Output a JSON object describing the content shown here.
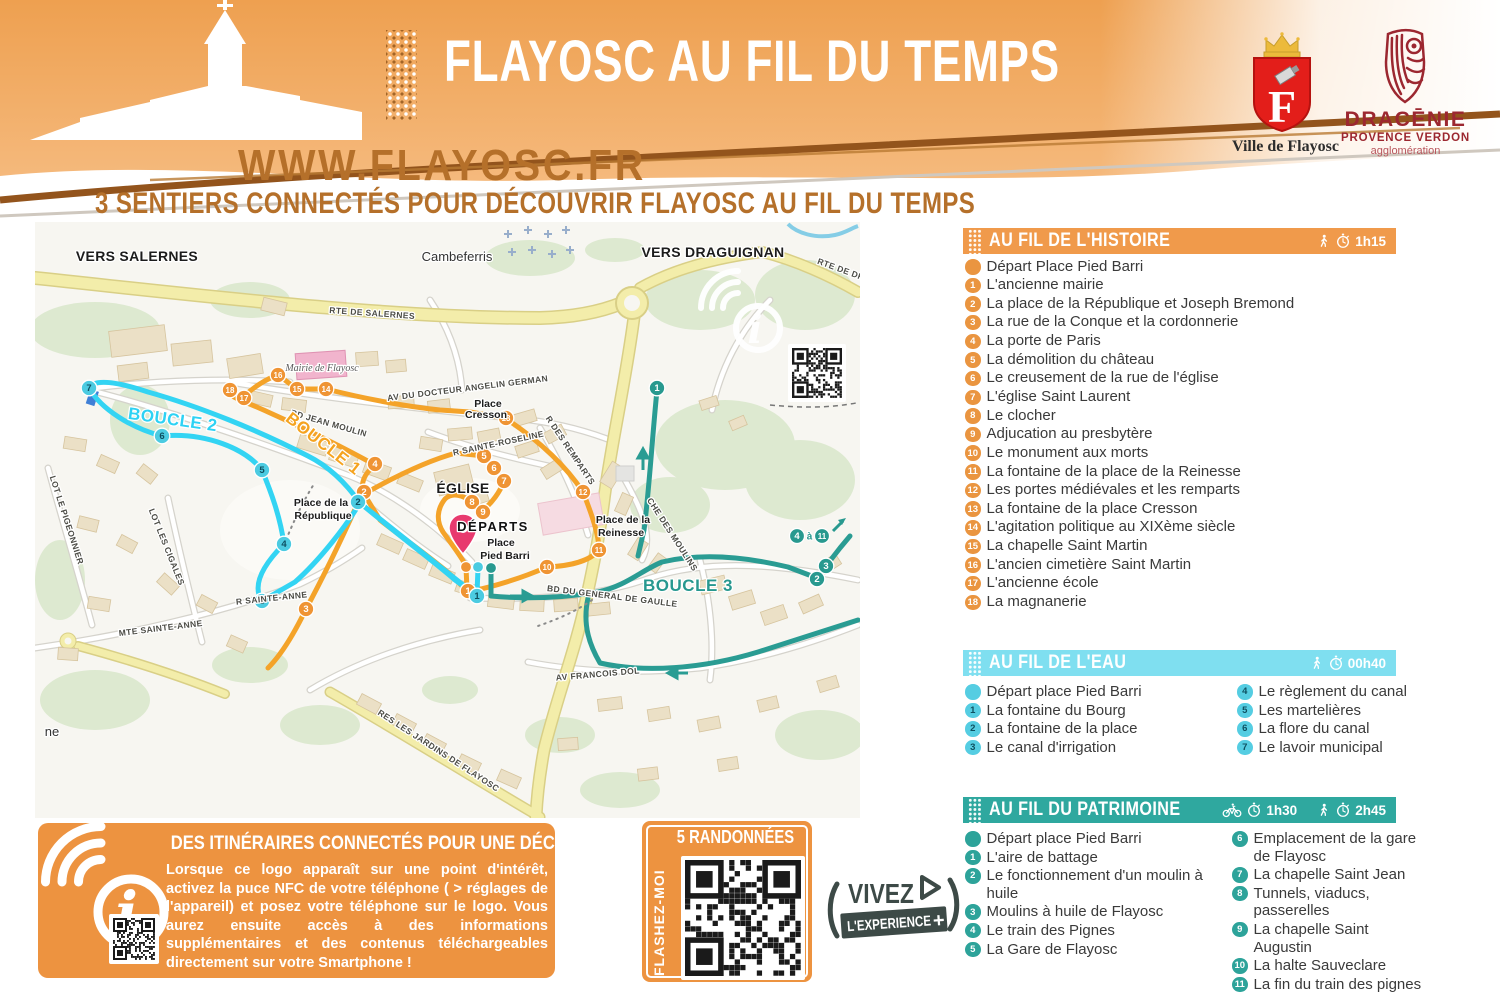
{
  "header": {
    "title": "FLAYOSC AU FIL DU TEMPS",
    "website": "WWW.FLAYOSC.FR",
    "subtitle": "3 SENTIERS CONNECTÉS POUR DÉCOUVRIR FLAYOSC AU FIL DU TEMPS",
    "ville_logo_letter": "F",
    "ville_logo_caption": "Ville de Flayosc",
    "dracenie_line1": "DRACĒNIE",
    "dracenie_line2": "PROVENCE VERDON",
    "dracenie_line3": "agglomération"
  },
  "colors": {
    "primary_orange": "#ed9340",
    "histoire_header": "#f09a4b",
    "eau_header": "#7fdff0",
    "patrimoine_header": "#2fa89f",
    "boucle1": "#f5a31f",
    "boucle2": "#2dd2f4",
    "boucle3": "#27988f",
    "brown_text": "#b5702a"
  },
  "sections": [
    {
      "title": "AU FIL DE L'HISTOIRE",
      "walk_time": "1h15",
      "depart": "Départ Place Pied Barri",
      "items": [
        "L'ancienne mairie",
        "La place de la République et Joseph Bremond",
        "La rue de la Conque et la cordonnerie",
        "La porte de Paris",
        "La démolition du château",
        "Le creusement de la rue de l'église",
        "L'église Saint Laurent",
        "Le clocher",
        "Adjucation au presbytère",
        "Le monument aux morts",
        "La fontaine de la place de la Reinesse",
        "Les portes médiévales et les remparts",
        "La fontaine de la place Cresson",
        "L'agitation politique au XIXème siècle",
        "La chapelle Saint Martin",
        "L'ancien cimetière Saint Martin",
        "L'ancienne école",
        "La magnanerie"
      ]
    },
    {
      "title": "AU FIL DE L'EAU",
      "walk_time": "00h40",
      "depart": "Départ place Pied Barri",
      "items": [
        "La fontaine du Bourg",
        "La fontaine de la place",
        "Le canal d'irrigation",
        "Le règlement du canal",
        "Les martelières",
        "La flore du canal",
        "Le lavoir municipal"
      ]
    },
    {
      "title": "AU FIL DU PATRIMOINE",
      "bike_time": "1h30",
      "walk_time": "2h45",
      "depart": "Départ place Pied Barri",
      "items": [
        "L'aire de battage",
        "Le fonctionnement d'un moulin à\nhuile",
        "Moulins à huile de Flayosc",
        "Le train des Pignes",
        "La Gare de Flayosc",
        "Emplacement de la gare\nde Flayosc",
        "La chapelle Saint Jean",
        "Tunnels, viaducs, passerelles",
        "La chapelle Saint Augustin",
        "La halte Sauveclare",
        "La fin du train des pignes"
      ]
    }
  ],
  "map": {
    "labels": [
      {
        "t": "VERS SALERNES",
        "x": 137,
        "y": 261,
        "c": "big"
      },
      {
        "t": "Cambeferris",
        "x": 457,
        "y": 261,
        "c": "med"
      },
      {
        "t": "VERS DRAGUIGNAN",
        "x": 713,
        "y": 257,
        "c": "big"
      },
      {
        "t": "RTE DE SALERNES",
        "x": 372,
        "y": 316,
        "r": 4,
        "c": "street"
      },
      {
        "t": "RTE DE DR",
        "x": 840,
        "y": 272,
        "r": 20,
        "c": "street"
      },
      {
        "t": "Mairie de Flayosc",
        "x": 322,
        "y": 371,
        "c": "ital"
      },
      {
        "t": "AV DU DOCTEUR ANGELIN GERMAN",
        "x": 468,
        "y": 391,
        "r": -7,
        "c": "street"
      },
      {
        "t": "BD JEAN MOULIN",
        "x": 328,
        "y": 426,
        "r": 16,
        "c": "street"
      },
      {
        "t": "Place",
        "x": 488,
        "y": 407,
        "c": "place"
      },
      {
        "t": "Cresson",
        "x": 486,
        "y": 418,
        "c": "place"
      },
      {
        "t": "R SAINTE-ROSELINE",
        "x": 499,
        "y": 446,
        "r": -12,
        "c": "street"
      },
      {
        "t": "R DES REMPARTS",
        "x": 568,
        "y": 452,
        "r": 56,
        "c": "street"
      },
      {
        "t": "ÉGLISE",
        "x": 463,
        "y": 493,
        "c": "big"
      },
      {
        "t": "DÉPARTS",
        "x": 493,
        "y": 531,
        "c": "big2"
      },
      {
        "t": "Place",
        "x": 501,
        "y": 546,
        "c": "place"
      },
      {
        "t": "Pied Barri",
        "x": 505,
        "y": 559,
        "c": "place"
      },
      {
        "t": "Place de la",
        "x": 321,
        "y": 506,
        "c": "place"
      },
      {
        "t": "République",
        "x": 323,
        "y": 519,
        "c": "place"
      },
      {
        "t": "Place de la",
        "x": 623,
        "y": 523,
        "c": "place"
      },
      {
        "t": "Reinesse",
        "x": 621,
        "y": 536,
        "c": "place"
      },
      {
        "t": "BOUCLE 1",
        "x": 320,
        "y": 448,
        "r": 38,
        "c": "b1"
      },
      {
        "t": "BOUCLE 2",
        "x": 172,
        "y": 425,
        "r": 8,
        "c": "b2"
      },
      {
        "t": "BOUCLE 3",
        "x": 688,
        "y": 591,
        "c": "b3"
      },
      {
        "t": "CHE DES MOULINS",
        "x": 670,
        "y": 536,
        "r": 57,
        "c": "street"
      },
      {
        "t": "BD DU GENERAL DE GAULLE",
        "x": 612,
        "y": 599,
        "r": 7,
        "c": "street"
      },
      {
        "t": "AV FRANCOIS DOL",
        "x": 598,
        "y": 677,
        "r": -5,
        "c": "street"
      },
      {
        "t": "MTE SAINTE-ANNE",
        "x": 161,
        "y": 631,
        "r": -7,
        "c": "street"
      },
      {
        "t": "R SAINTE-ANNE",
        "x": 272,
        "y": 601,
        "r": -6,
        "c": "street"
      },
      {
        "t": "LOT LES CIGALES",
        "x": 164,
        "y": 548,
        "r": 68,
        "c": "street"
      },
      {
        "t": "LOT LE PIGEONNIER",
        "x": 64,
        "y": 521,
        "r": 72,
        "c": "street"
      },
      {
        "t": "RES LES JARDINS DE FLAYOSC",
        "x": 437,
        "y": 753,
        "r": 33,
        "c": "street"
      },
      {
        "t": "ne",
        "x": 52,
        "y": 736,
        "c": "med"
      }
    ],
    "markers": {
      "orange": [
        [
          1,
          468,
          591
        ],
        [
          2,
          364,
          492
        ],
        [
          3,
          306,
          609
        ],
        [
          4,
          375,
          464
        ],
        [
          5,
          484,
          456
        ],
        [
          6,
          494,
          468
        ],
        [
          7,
          504,
          481
        ],
        [
          8,
          472,
          502
        ],
        [
          9,
          483,
          512
        ],
        [
          10,
          547,
          567
        ],
        [
          11,
          599,
          550
        ],
        [
          12,
          583,
          492
        ],
        [
          13,
          506,
          418
        ],
        [
          14,
          326,
          389
        ],
        [
          15,
          297,
          389
        ],
        [
          16,
          278,
          375
        ],
        [
          17,
          244,
          398
        ],
        [
          18,
          230,
          390
        ]
      ],
      "cyan": [
        [
          1,
          477,
          596
        ],
        [
          2,
          358,
          502
        ],
        [
          3,
          262,
          601
        ],
        [
          4,
          284,
          544
        ],
        [
          5,
          262,
          470
        ],
        [
          6,
          162,
          436
        ],
        [
          7,
          89,
          388
        ]
      ],
      "teal": [
        [
          1,
          657,
          388
        ],
        [
          2,
          817,
          579
        ],
        [
          3,
          826,
          566
        ]
      ]
    },
    "depart_dots": [
      [
        "orange",
        466,
        567
      ],
      [
        "cyan",
        478,
        567
      ],
      [
        "teal",
        491,
        568
      ]
    ],
    "range_note": {
      "from": "4",
      "word": "à",
      "to": "11",
      "x": 797,
      "y": 536
    }
  },
  "nfc_box": {
    "title": "DES ITINÉRAIRES CONNECTÉS POUR UNE DÉCOUVERTE AMPLIFIÉE",
    "body": "Lorsque ce logo apparaît sur une point d'intérêt, activez la puce NFC de votre téléphone ( > réglages de l'appareil) et posez votre téléphone sur le logo. Vous aurez ensuite accès à des informations supplémentaires et des contenus téléchargeables directement sur votre Smartphone !"
  },
  "qr_box": {
    "title": "5 RANDONNÉES",
    "side_label": "FLASHEZ-MOI"
  },
  "vivez": {
    "word1": "VIVEZ",
    "word2": "L'EXPERIENCE",
    "plus": "+"
  }
}
